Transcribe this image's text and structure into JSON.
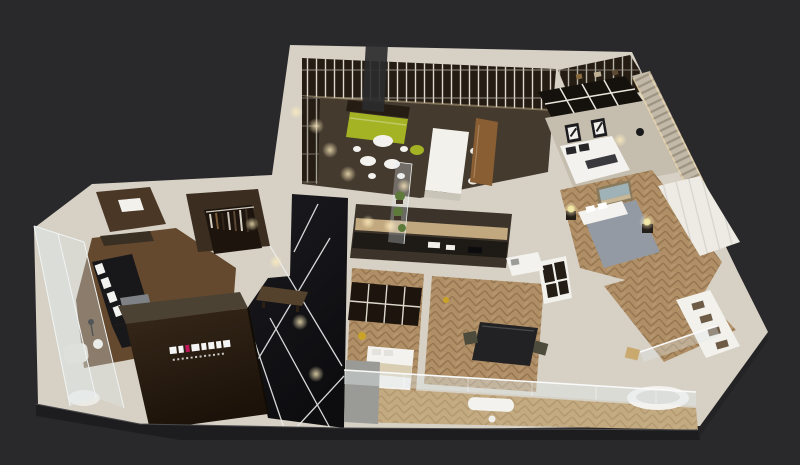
{
  "scene": {
    "type": "isometric-3d-apartment-floorplan-render",
    "description": "Bird's-eye 3D render of a modern apartment floor plan: open dining-living area with lime green sofa, kitchen island, black marble entry hall with white inlay lines, dark feature wall with white studio logo, bedrooms with herringbone wood floors, wrap-around glass balcony, on a dark charcoal background",
    "background": "#29292b"
  },
  "palette": {
    "wall": "#d6d0c5",
    "wall_shade": "#b9b2a4",
    "base_shadow": "#232325",
    "plinth_face": "#1d1d1f",
    "floor_dark": "#443a2e",
    "floor_kitchen": "#3c342a",
    "floor_wood": "#64492f",
    "floor_herringbone": "#b08f66",
    "floor_balcony": "#c3aa80",
    "floor_greige": "#c5bdae",
    "floor_walkin": "#4a3726",
    "floor_closet": "#3b2e20",
    "floor_marble_edge": "#16161a",
    "marble_line": "#ededed",
    "glass": "#dfe9ec",
    "sofa_green": "#a3b323",
    "sofa_black": "#18181a",
    "bed_white": "#f3f2ee",
    "bed_gray": "#939aa4",
    "counter_white": "#f2f1ec",
    "counter_side": "#c9c4b8",
    "counter_dark": "#1e1a15",
    "backsplash": "#c2a87f",
    "shelf_dark": "#251d14",
    "closet_dark": "#1c140d",
    "wallpaper": "#c3b9a8",
    "wardrobe_white": "#edebe4",
    "logo_wall_top": "#4c4233",
    "logo_accent": "#c2185b",
    "logo_text": "#f5f5f5",
    "wood_panel": "#8a5e33",
    "dark_glass_panel": "#2b2b2e",
    "bench": "#55422d",
    "desk": "#222224",
    "table_gray": "#7e8286",
    "armchair": "#ddd7cc",
    "planter_gray": "#9a9a96",
    "plant": "#5d7a3a",
    "lamp_glow": "#d8e07e",
    "brass": "#c9a227",
    "painting_sky": "#9fb2b8",
    "painting_sand": "#c9b896",
    "art_frame": "#1c1c1e",
    "chair_olive": "#4c4b3c",
    "nightstand": "#241e18",
    "pillow_dark": "#27272a",
    "blanket_beige": "#d9cdb2",
    "tub_inner": "#d9d6cf"
  }
}
